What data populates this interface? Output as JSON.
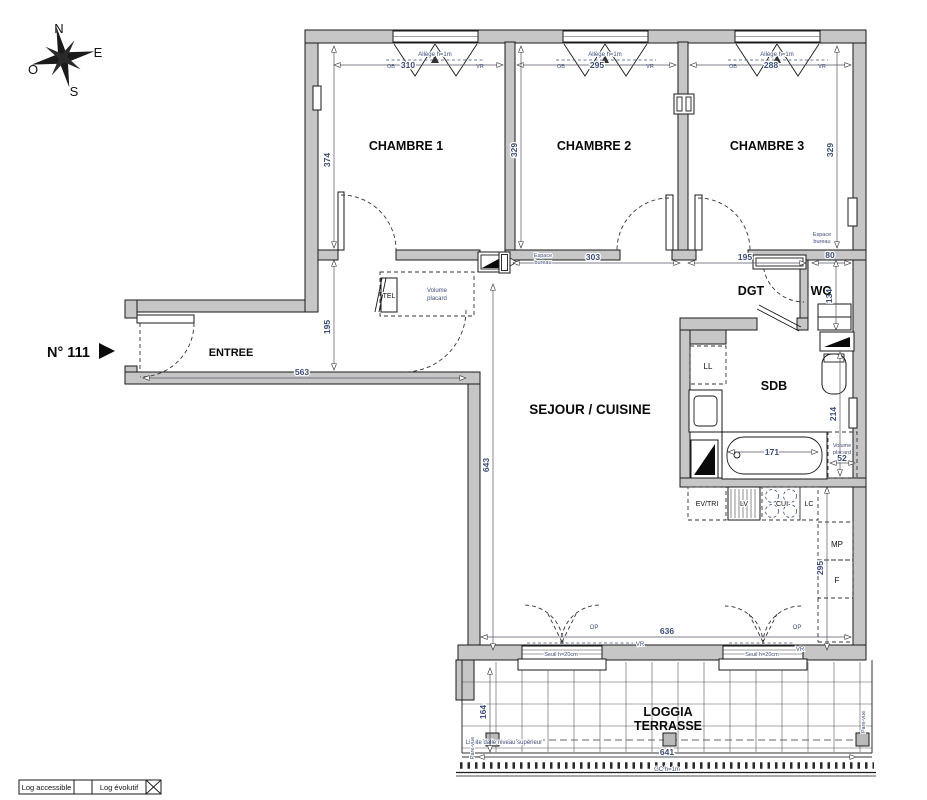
{
  "unit": {
    "number": "N° 111"
  },
  "compass": {
    "north": "N",
    "east": "E",
    "west": "O",
    "south": "S"
  },
  "rooms": {
    "chambre1": "CHAMBRE 1",
    "chambre2": "CHAMBRE 2",
    "chambre3": "CHAMBRE 3",
    "entree": "ENTREE",
    "sejour_cuisine": "SEJOUR / CUISINE",
    "dgt": "DGT",
    "wc": "WC",
    "sdb": "SDB",
    "loggia_line1": "LOGGIA",
    "loggia_line2": "TERRASSE"
  },
  "dims": {
    "ch1_width": "310",
    "ch2_width": "295",
    "ch3_width": "288",
    "ch1_depth": "374",
    "ch2_depth": "329",
    "ch3_depth": "329",
    "hall_a": "303",
    "hall_b": "195",
    "hall_c": "80",
    "entree_depth": "195",
    "entree_width": "563",
    "sejour_depth": "643",
    "sejour_width": "636",
    "wc_depth": "134",
    "sdb_depth": "214",
    "bath_width": "171",
    "placard_width": "52",
    "kitchen_depth": "295",
    "loggia_depth": "164",
    "loggia_width": "641"
  },
  "annotations": {
    "allege": "Allège h=1m",
    "ob": "OB",
    "vr": "VR",
    "op": "OP",
    "espace": "Espace",
    "bureau": "bureau",
    "volume": "Volume",
    "placard": "placard",
    "tel": "TEL",
    "seuil": "Seuil h=20cm",
    "limite_dalle": "Limite dalle niveau supérieur",
    "garde_corps": "GC h=1m",
    "pare_vue": "Pare-vue"
  },
  "fixtures": {
    "washer": "LL",
    "sink_unit": "EV/TRI",
    "dishwasher": "LV",
    "cooktop": "CUI",
    "lc": "LC",
    "mp": "MP",
    "fridge": "F"
  },
  "legend": {
    "accessible": "Log accessible",
    "evolutif": "Log évolutif"
  },
  "colors": {
    "wall": "#c6c6c6",
    "line": "#1a1a1a",
    "dim_text": "#3d4d78"
  }
}
